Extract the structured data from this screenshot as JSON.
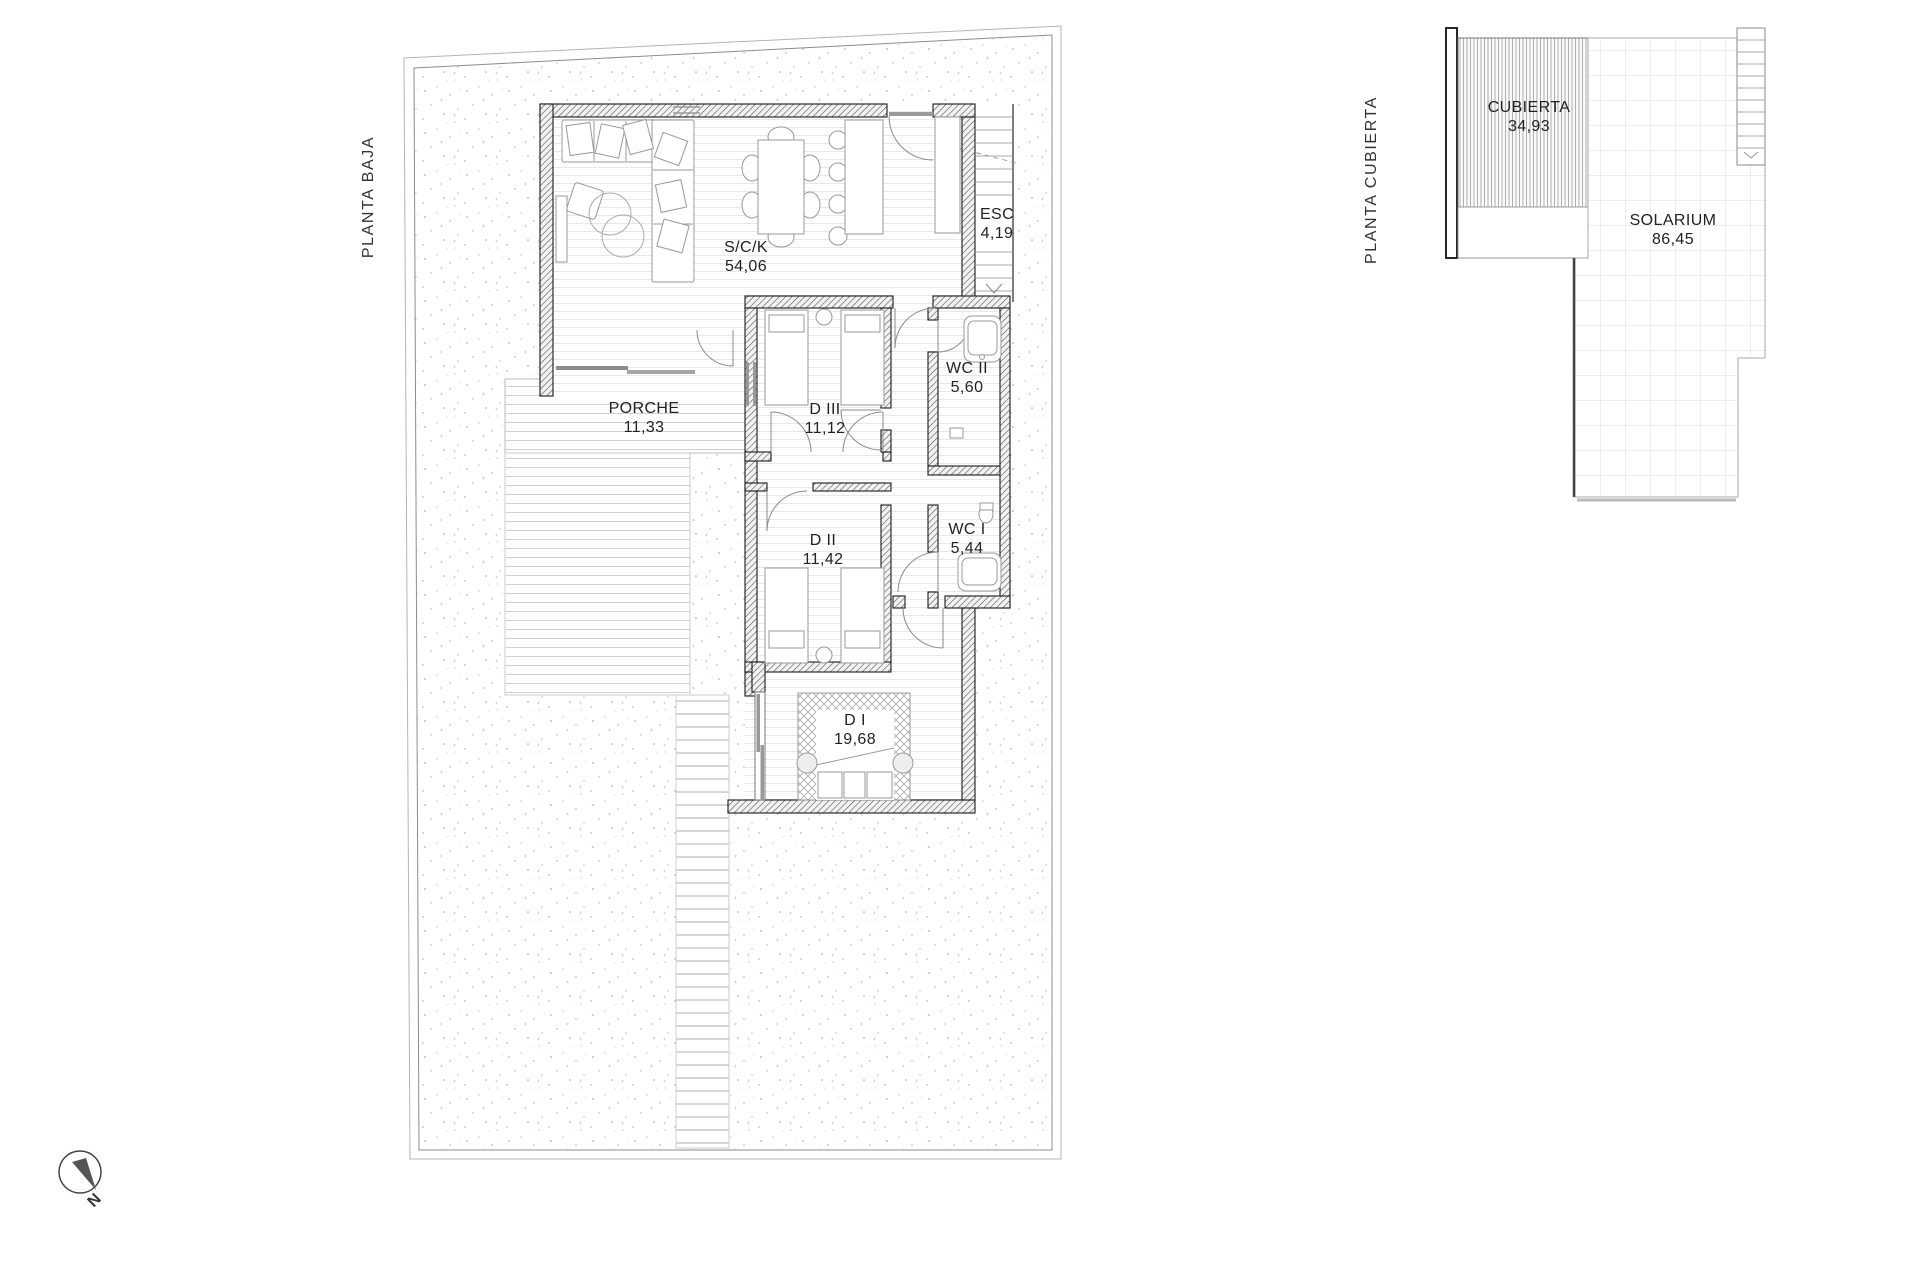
{
  "plans": {
    "planta_baja": {
      "title": "PLANTA BAJA",
      "rooms": [
        {
          "name": "S/C/K",
          "area": "54,06"
        },
        {
          "name": "ESC",
          "area": "4,19"
        },
        {
          "name": "PORCHE",
          "area": "11,33"
        },
        {
          "name": "D III",
          "area": "11,12"
        },
        {
          "name": "WC II",
          "area": "5,60"
        },
        {
          "name": "D II",
          "area": "11,42"
        },
        {
          "name": "WC I",
          "area": "5,44"
        },
        {
          "name": "D I",
          "area": "19,68"
        }
      ]
    },
    "planta_cubierta": {
      "title": "PLANTA CUBIERTA",
      "rooms": [
        {
          "name": "CUBIERTA",
          "area": "34,93"
        },
        {
          "name": "SOLARIUM",
          "area": "86,45"
        }
      ]
    }
  },
  "compass": {
    "label": "N"
  },
  "colors": {
    "background": "#ffffff",
    "wall_line": "#1a1a1a",
    "wall_hatch": "#555555",
    "garden_dot": "#9a9a9a",
    "floor_line": "#e8e8e8",
    "deck_line": "#d0d0d0",
    "grid_line": "#dddddd",
    "door_arc": "#8a8a8a",
    "text": "#222222"
  }
}
